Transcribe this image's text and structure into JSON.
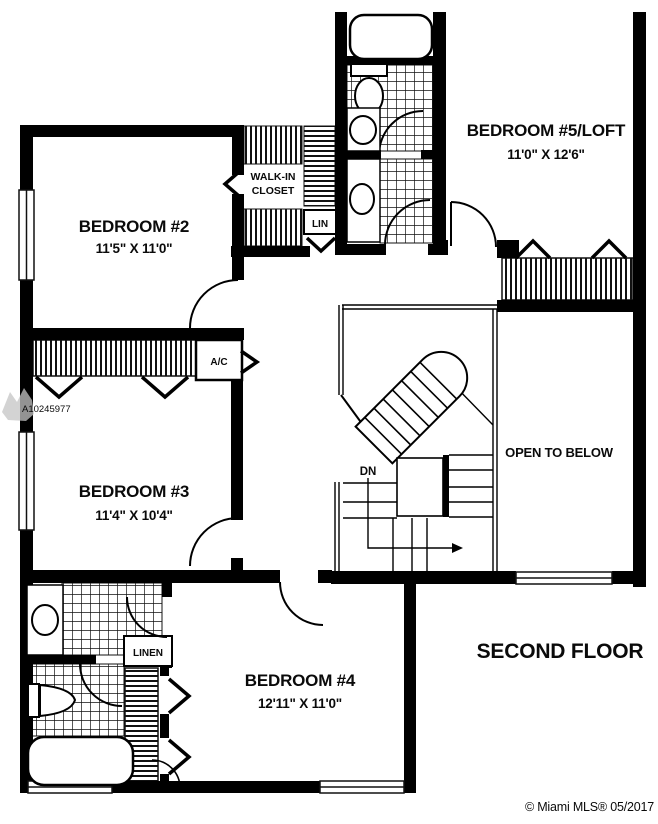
{
  "plan": {
    "floor_label": "SECOND FLOOR",
    "rooms": {
      "bedroom2": {
        "name": "BEDROOM #2",
        "dims": "11'5\" X 11'0\""
      },
      "bedroom5": {
        "name": "BEDROOM #5/LOFT",
        "dims": "11'0\" X 12'6\""
      },
      "bedroom3": {
        "name": "BEDROOM #3",
        "dims": "11'4\" X 10'4\""
      },
      "bedroom4": {
        "name": "BEDROOM #4",
        "dims": "12'11\" X 11'0\""
      }
    },
    "labels": {
      "walk_in_line1": "WALK-IN",
      "walk_in_line2": "CLOSET",
      "lin": "LIN",
      "linen": "LINEN",
      "ac": "A/C",
      "dn": "DN",
      "open_to_below": "OPEN TO BELOW"
    },
    "watermarks": {
      "listing_id": "A10245977",
      "credit": "© Miami MLS® 05/2017"
    },
    "colors": {
      "wall": "#000000",
      "background": "#ffffff",
      "watermark_gray": "#a8a8a8"
    }
  }
}
